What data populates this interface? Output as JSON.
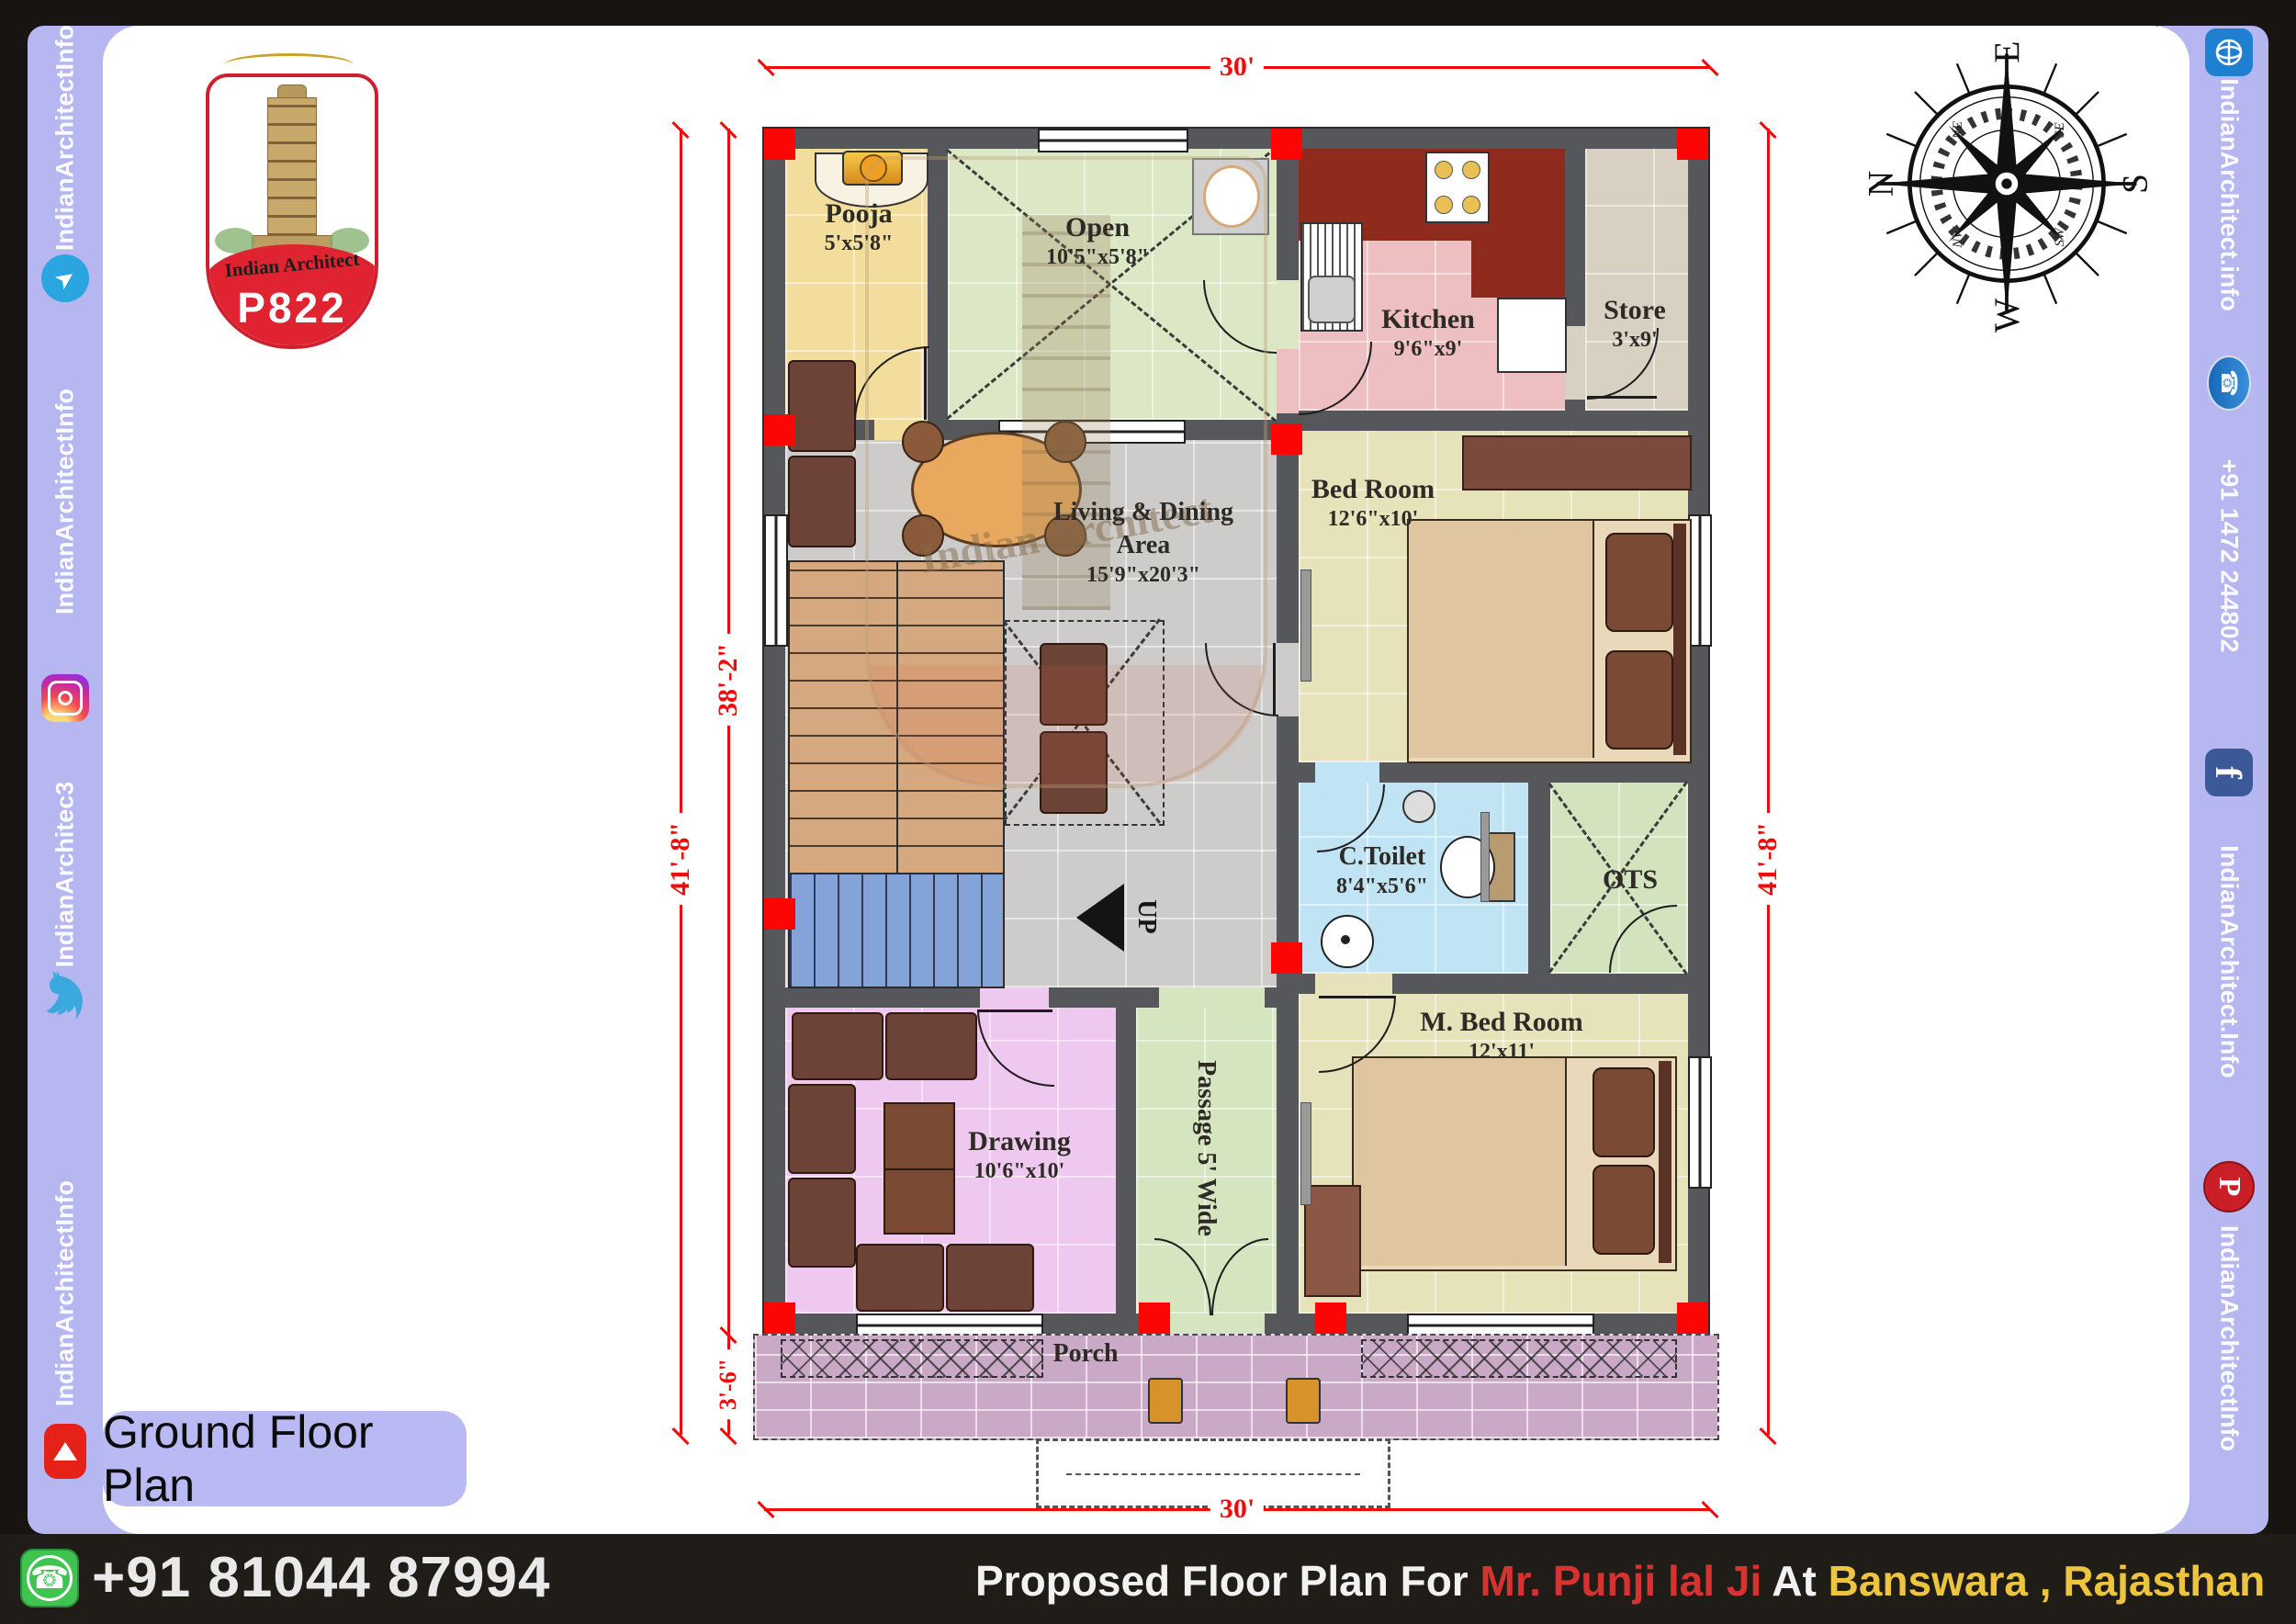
{
  "branding": {
    "logo_text": "Indian Architect",
    "logo_code": "P822",
    "watermark": "Indian Architect"
  },
  "left_sidebar": {
    "items": [
      {
        "label": "IndianArchitectInfo"
      },
      {
        "icon": "telegram"
      },
      {
        "label": "IndianArchitectInfo"
      },
      {
        "icon": "instagram"
      },
      {
        "label": "IndianArchitec3"
      },
      {
        "icon": "twitter"
      },
      {
        "label": "IndianArchitectInfo"
      },
      {
        "icon": "youtube"
      }
    ]
  },
  "right_sidebar": {
    "items": [
      {
        "icon": "www"
      },
      {
        "label": "IndianArchitect.info"
      },
      {
        "icon": "phone"
      },
      {
        "label": "+91 1472 244802"
      },
      {
        "icon": "facebook"
      },
      {
        "label": "IndianArchitect.Info"
      },
      {
        "icon": "pinterest"
      },
      {
        "label": "IndianArchitectInfo"
      }
    ]
  },
  "plan_title": "Ground Floor Plan",
  "compass": {
    "n": "N",
    "e": "E",
    "s": "S",
    "w": "W",
    "ne": "NE",
    "se": "SE",
    "sw": "SW",
    "nw": "NW"
  },
  "rooms": {
    "pooja": {
      "name": "Pooja",
      "size": "5'x5'8\""
    },
    "open": {
      "name": "Open",
      "size": "10'5\"x5'8\""
    },
    "kitchen": {
      "name": "Kitchen",
      "size": "9'6\"x9'"
    },
    "store": {
      "name": "Store",
      "size": "3'x9'"
    },
    "living": {
      "name": "Living & Dining Area",
      "size": "15'9\"x20'3\""
    },
    "bed": {
      "name": "Bed Room",
      "size": "12'6\"x10'"
    },
    "toilet": {
      "name": "C.Toilet",
      "size": "8'4\"x5'6\""
    },
    "ots": {
      "name": "OTS"
    },
    "drawing": {
      "name": "Drawing",
      "size": "10'6\"x10'"
    },
    "passage": {
      "name": "Passage 5' Wide"
    },
    "mbed": {
      "name": "M. Bed Room",
      "size": "12'x11'"
    },
    "porch": {
      "name": "Porch"
    }
  },
  "stairs": {
    "up_label": "UP"
  },
  "dimensions": {
    "top": "30'",
    "bottom": "30'",
    "left_outer": "41'-8\"",
    "left_inner": "38'-2\"",
    "left_porch": "3'-6\"",
    "right": "41'-8\""
  },
  "footer": {
    "phone": "+91 81044 87994",
    "caption": [
      {
        "text": "Proposed Floor Plan For ",
        "color": "#f2f2f2"
      },
      {
        "text": "Mr. Punji lal Ji",
        "color": "#d53230"
      },
      {
        "text": "  At ",
        "color": "#f2f2f2"
      },
      {
        "text": "Banswara , Rajasthan",
        "color": "#ecc43d"
      }
    ]
  },
  "colors": {
    "sidebar": "#b6b6f0",
    "frame": "#171411",
    "wall": "#56575a",
    "dimension_red": "#f30a0a",
    "accent_red": "#fe0505"
  }
}
